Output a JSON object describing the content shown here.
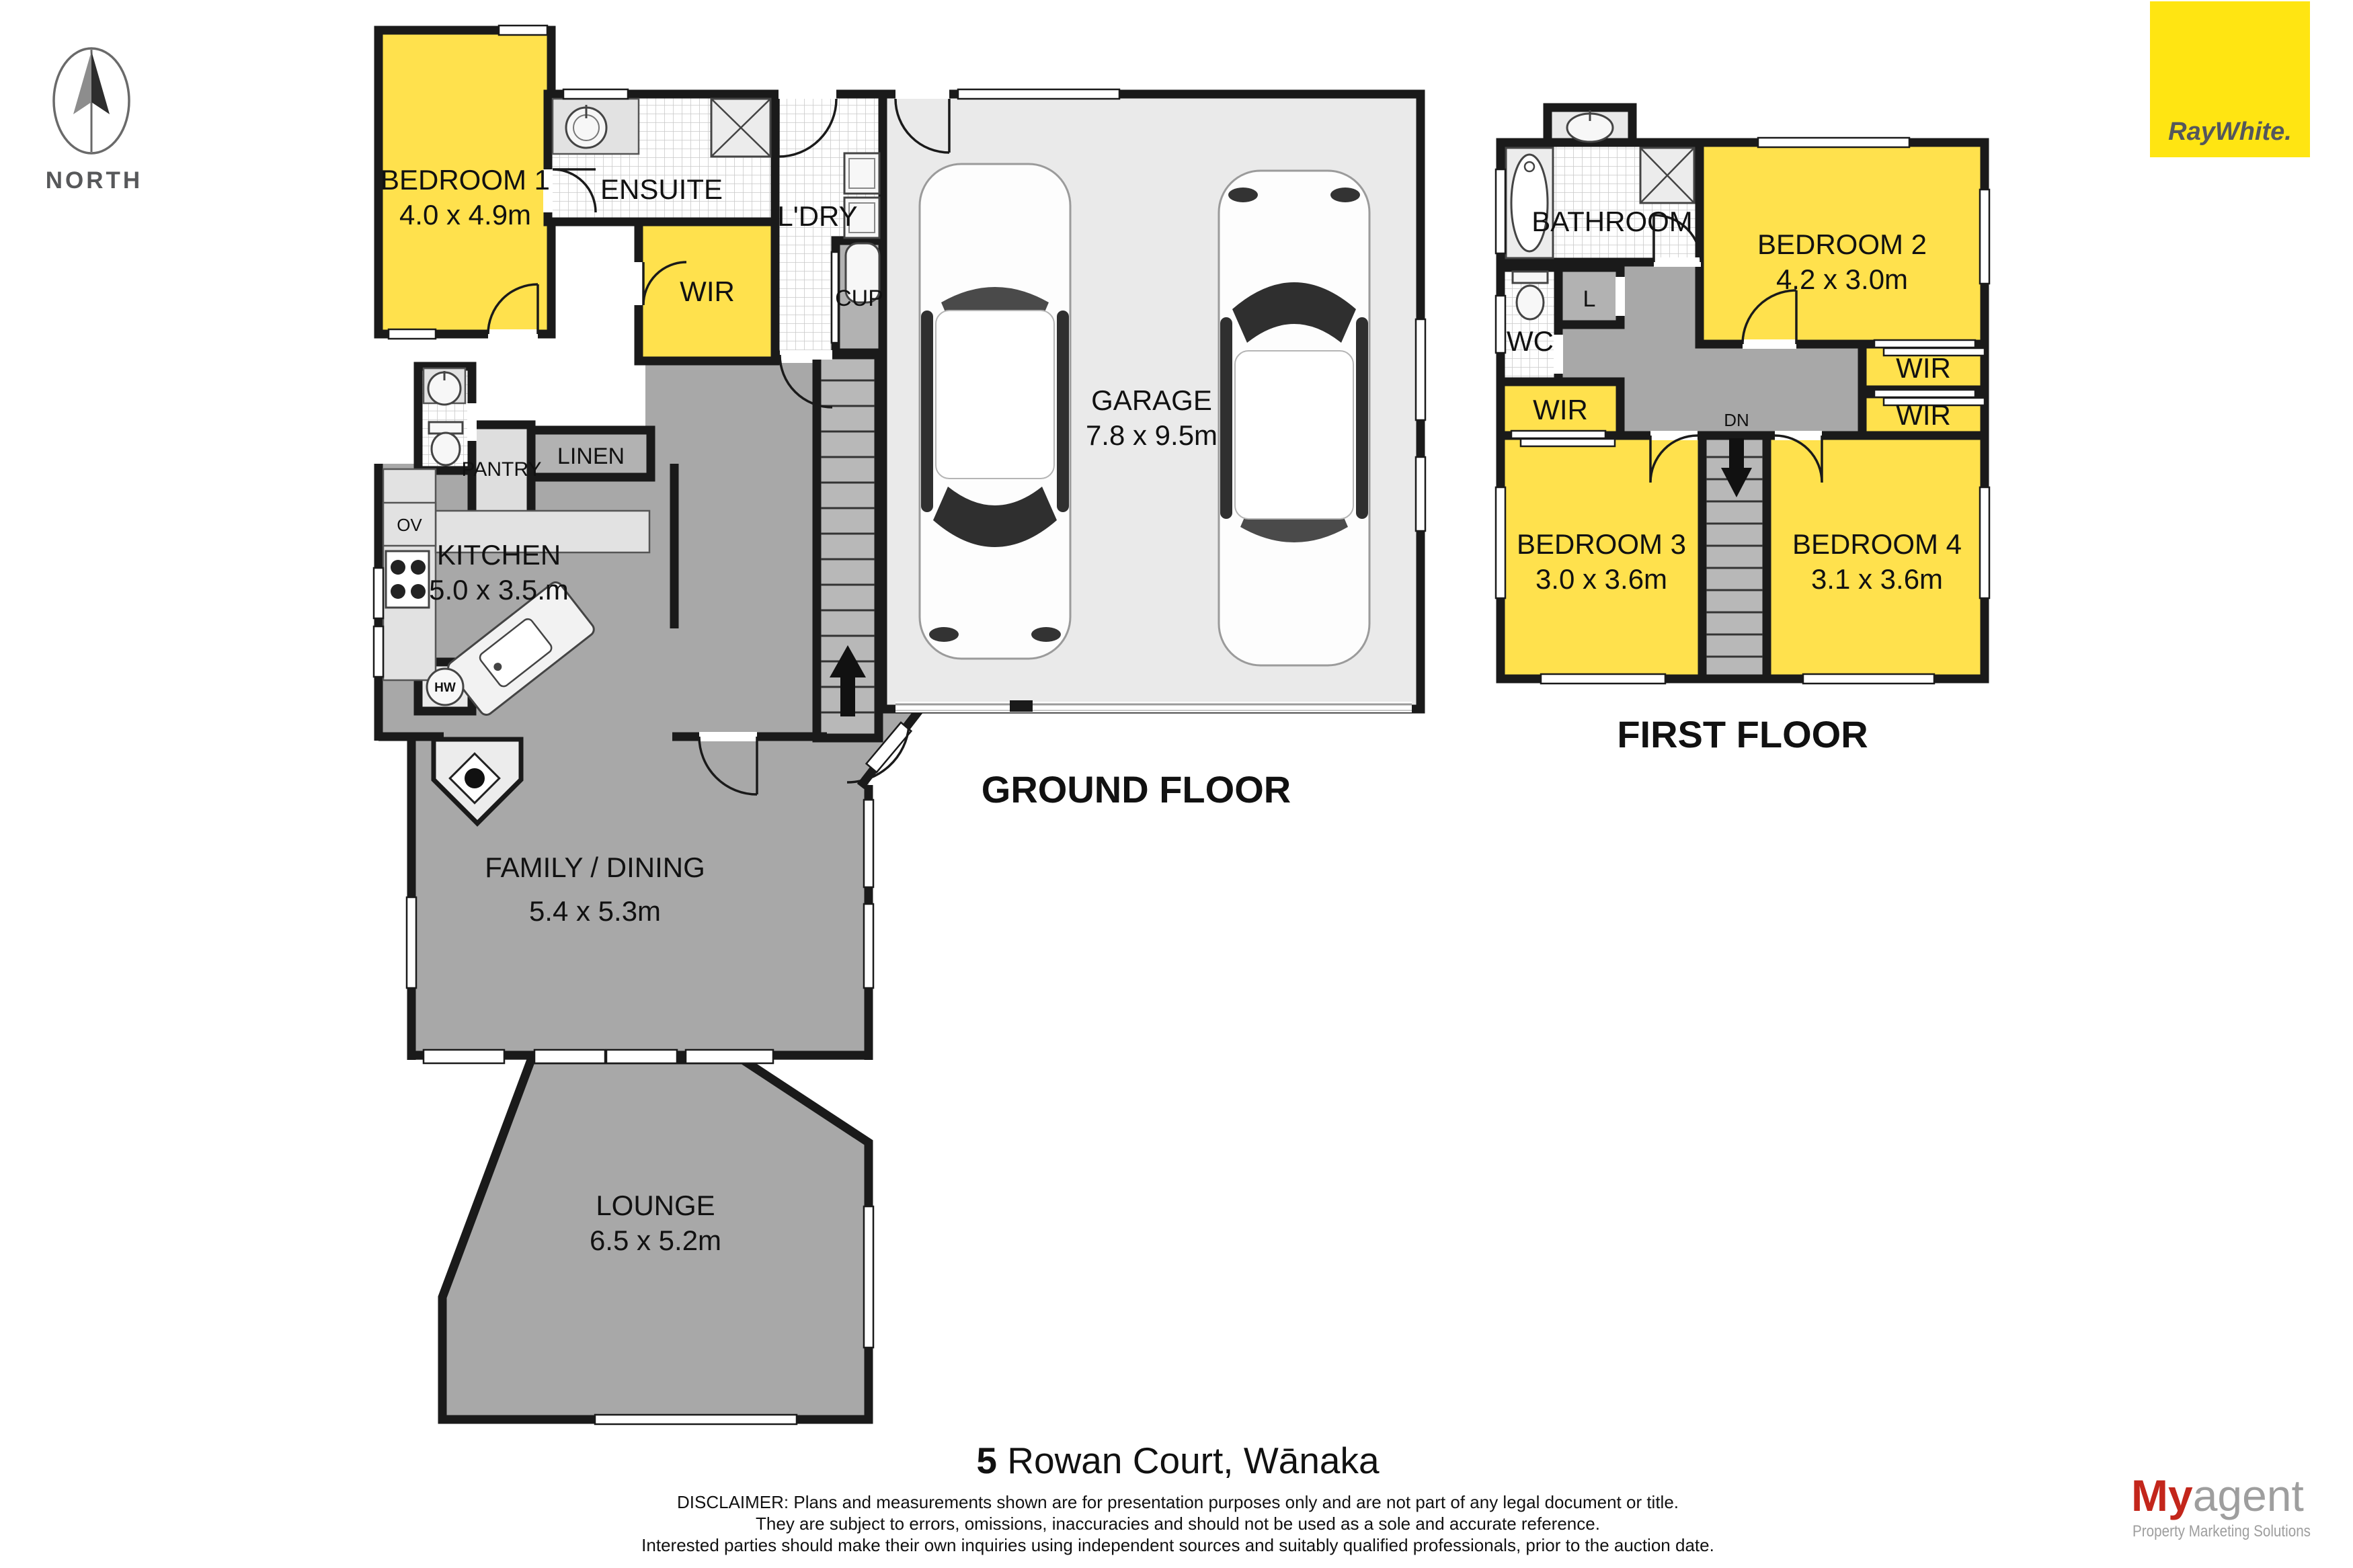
{
  "colors": {
    "wall": "#1a1a1a",
    "room_yellow": "#ffe14d",
    "floor_gray": "#a8a8a8",
    "garage_gray": "#eaeaea",
    "closet_gray": "#b2b2b2",
    "brand_yellow": "#ffe512",
    "brand_text_gray": "#54575c",
    "myagent_red": "#c3261b",
    "myagent_gray": "#9e9e9e"
  },
  "compass": {
    "label": "NORTH"
  },
  "logo": {
    "ray_white": "RayWhite."
  },
  "ground_floor": {
    "title": "GROUND FLOOR",
    "bedroom1": {
      "name": "BEDROOM 1",
      "dims": "4.0 x 4.9m"
    },
    "ensuite": {
      "name": "ENSUITE"
    },
    "wir": {
      "name": "WIR"
    },
    "laundry": {
      "name": "L'DRY"
    },
    "cupboard": {
      "name": "CUP"
    },
    "garage": {
      "name": "GARAGE",
      "dims": "7.8 x 9.5m"
    },
    "pantry": {
      "name": "PANTRY"
    },
    "linen": {
      "name": "LINEN"
    },
    "kitchen": {
      "name": "KITCHEN",
      "dims": "5.0 x 3.5.m"
    },
    "oven": {
      "name": "OV"
    },
    "hot_water": {
      "name": "HW"
    },
    "family_dining": {
      "name": "FAMILY / DINING",
      "dims": "5.4 x 5.3m"
    },
    "lounge": {
      "name": "LOUNGE",
      "dims": "6.5 x 5.2m"
    }
  },
  "first_floor": {
    "title": "FIRST FLOOR",
    "bathroom": {
      "name": "BATHROOM"
    },
    "bedroom2": {
      "name": "BEDROOM 2",
      "dims": "4.2 x 3.0m"
    },
    "linen_cupboard": {
      "name": "L"
    },
    "wc": {
      "name": "WC"
    },
    "wir_left": {
      "name": "WIR"
    },
    "wir_right_upper": {
      "name": "WIR"
    },
    "wir_right_lower": {
      "name": "WIR"
    },
    "stairs_down": {
      "name": "DN"
    },
    "bedroom3": {
      "name": "BEDROOM 3",
      "dims": "3.0 x 3.6m"
    },
    "bedroom4": {
      "name": "BEDROOM 4",
      "dims": "3.1 x 3.6m"
    }
  },
  "footer": {
    "address_number": "5",
    "address_rest": " Rowan Court, Wānaka",
    "disclaimer_line1": "DISCLAIMER: Plans and measurements shown are for presentation purposes only and are not part of any legal document or title.",
    "disclaimer_line2": "They are subject to errors, omissions, inaccuracies and should not be used as a sole and accurate reference.",
    "disclaimer_line3": "Interested parties should make their own inquiries using independent sources and suitably qualified professionals, prior to the auction date."
  },
  "myagent": {
    "part1": "My",
    "part2": "agent",
    "tagline": "Property Marketing Solutions"
  }
}
